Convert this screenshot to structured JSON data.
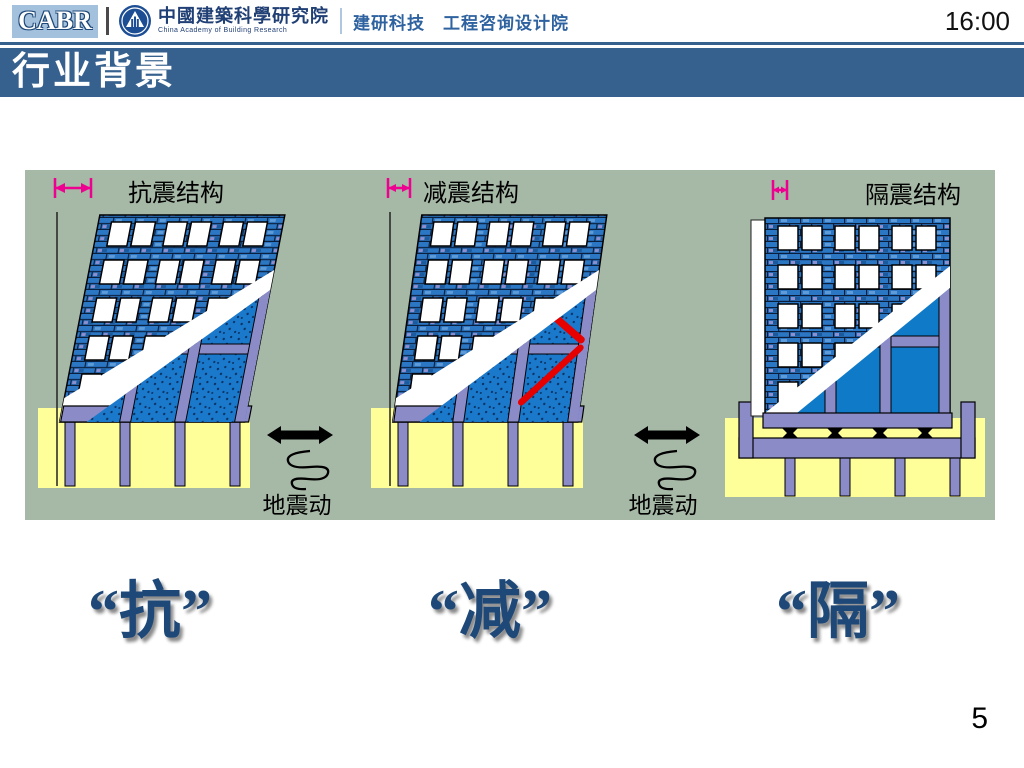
{
  "header": {
    "logo": "CABR",
    "org_zh": "中國建築科學研究院",
    "org_en": "China Academy of Building Research",
    "division": "建研科技　工程咨询设计院",
    "clock": "16:00"
  },
  "title": "行业背景",
  "diagram": {
    "buildings": [
      {
        "label": "抗震结构",
        "concept": "抗",
        "roof_displacement": "large",
        "tilt": "large",
        "has_damper": false,
        "base_isolated": false
      },
      {
        "label": "减震结构",
        "concept": "减",
        "roof_displacement": "medium",
        "tilt": "medium",
        "has_damper": true,
        "base_isolated": false
      },
      {
        "label": "隔震结构",
        "concept": "隔",
        "roof_displacement": "small",
        "tilt": "none",
        "has_damper": false,
        "base_isolated": true
      }
    ],
    "ground_motion_label": "地震动",
    "colors": {
      "background": "#A6B8A6",
      "foundation": "#FFFF99",
      "frame": "#8B8BC8",
      "brick_wall": "#2B77C4",
      "infill_panel": "#0E7AC8",
      "damper_brace": "#E60000",
      "dimension_arrow": "#EE0090"
    }
  },
  "concepts": [
    "“抗”",
    "“减”",
    "“隔”"
  ],
  "page_number": "5",
  "theme": {
    "title_bar_color": "#36618F",
    "concept_text_color": "#1E4878"
  }
}
